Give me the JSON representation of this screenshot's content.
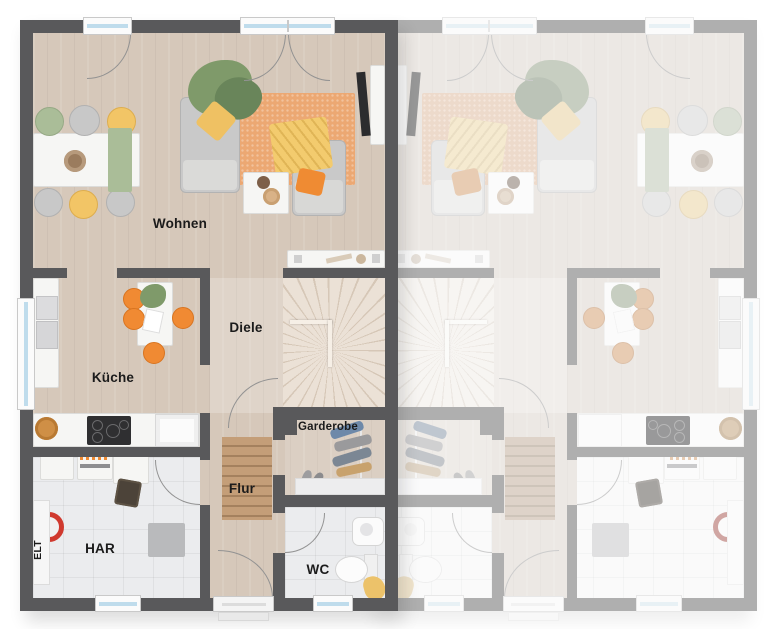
{
  "plan": {
    "type": "floor-plan",
    "units": {
      "left_labels_visible": true,
      "right_labels_visible": false
    }
  },
  "rooms": {
    "wohnen": "Wohnen",
    "kueche": "Küche",
    "diele": "Diele",
    "flur": "Flur",
    "garderobe": "Garderobe",
    "har": "HAR",
    "wc": "WC",
    "elt": "ELT"
  },
  "colors": {
    "wall": "#59595b",
    "wood_floor": "#d6c8ba",
    "tile_floor": "#ebecee",
    "stairs": "#ebe1d6",
    "living_rug": "#eca873",
    "flur_rug": "#c49e78",
    "accent_orange": "#f08a33",
    "accent_yellow": "#f2c566",
    "plant_green": "#7f9a6a",
    "sage_green": "#aabd98",
    "window_glass": "#bfdcec",
    "label_text": "#1b1b1b"
  }
}
